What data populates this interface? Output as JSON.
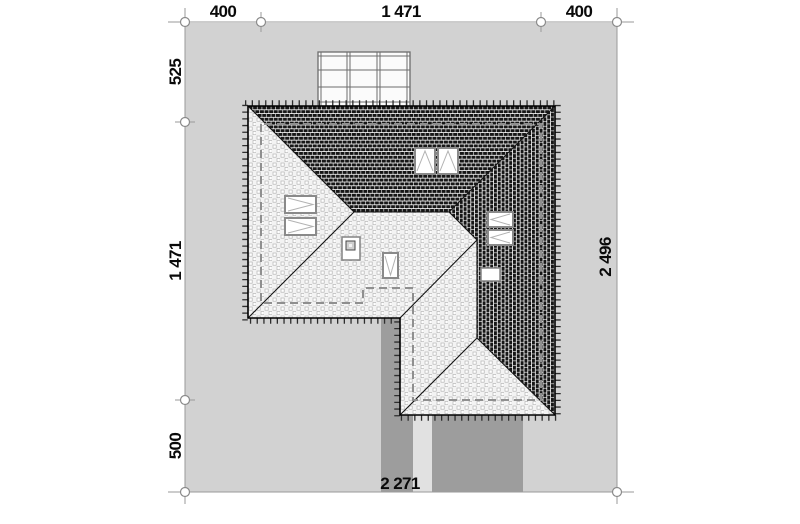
{
  "dimensions": {
    "top": [
      "400",
      "1 471",
      "400"
    ],
    "left": [
      "525",
      "1 471",
      "500"
    ],
    "right": [
      "2 496"
    ],
    "bottom": [
      "2 271"
    ]
  },
  "colors": {
    "plot": "#d2d2d2",
    "paving": "#9d9d9d",
    "path": "#e1e1e1",
    "roof_light": "#f3f3f3",
    "roof_dark": "#161616",
    "dim_text": "#0a0a0a"
  }
}
